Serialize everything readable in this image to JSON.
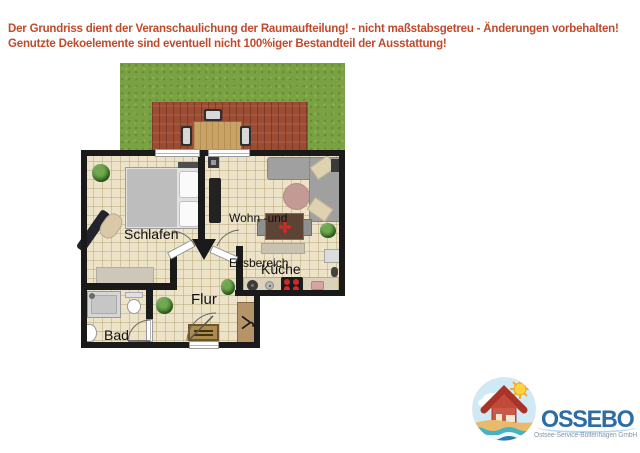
{
  "header": {
    "line1": "Der Grundriss dient der Veranschaulichung der Raumaufteilung! - nicht maßstabsgetreu - Änderungen vorbehalten!",
    "line2": "Genutzte Dekoelemente sind eventuell nicht 100%iger Bestandteil der Ausstattung!"
  },
  "floorplan": {
    "rooms": {
      "schlafen": {
        "label": "Schlafen"
      },
      "wohn": {
        "label_line1": "Wohn -und",
        "label_line2": "Essbereich"
      },
      "kueche": {
        "label": "Küche"
      },
      "flur": {
        "label": "Flur"
      },
      "bad": {
        "label": "Bad"
      }
    }
  },
  "logo": {
    "name": "OSSEBO",
    "subtitle": "Ostsee-Service-Boltenhagen GmbH"
  },
  "colors": {
    "header_text": "#c14a2c",
    "wall": "#1a1a1a",
    "floor": "#ece3c9",
    "lawn": "#7aa243",
    "deck": "#9c4c33",
    "table_wood": "#c9a265",
    "rug_rose": "#c49b94",
    "stove_burner": "#cf2a2a",
    "plant_green": "#3f7a28",
    "logo_blue": "#2d6ca6",
    "logo_subtitle": "#8796a6"
  }
}
